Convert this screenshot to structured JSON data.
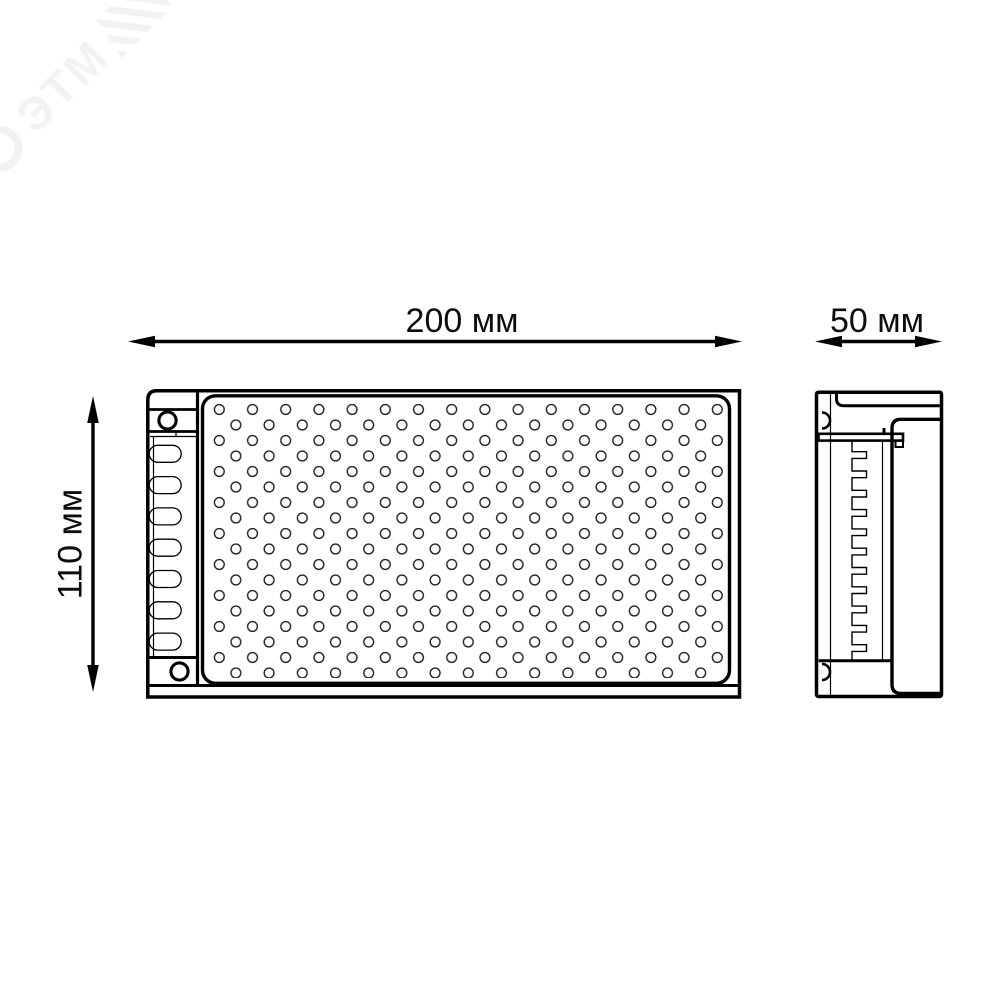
{
  "watermark": {
    "text": "ЭТМ"
  },
  "drawing": {
    "type": "technical-dimension-drawing",
    "background": "#ffffff",
    "stroke_color": "#000000",
    "dimensions": {
      "width": {
        "label": "200 мм",
        "value_mm": 200,
        "unit": "мм"
      },
      "depth": {
        "label": "50 мм",
        "value_mm": 50,
        "unit": "мм"
      },
      "height": {
        "label": "110 мм",
        "value_mm": 110,
        "unit": "мм"
      }
    }
  }
}
